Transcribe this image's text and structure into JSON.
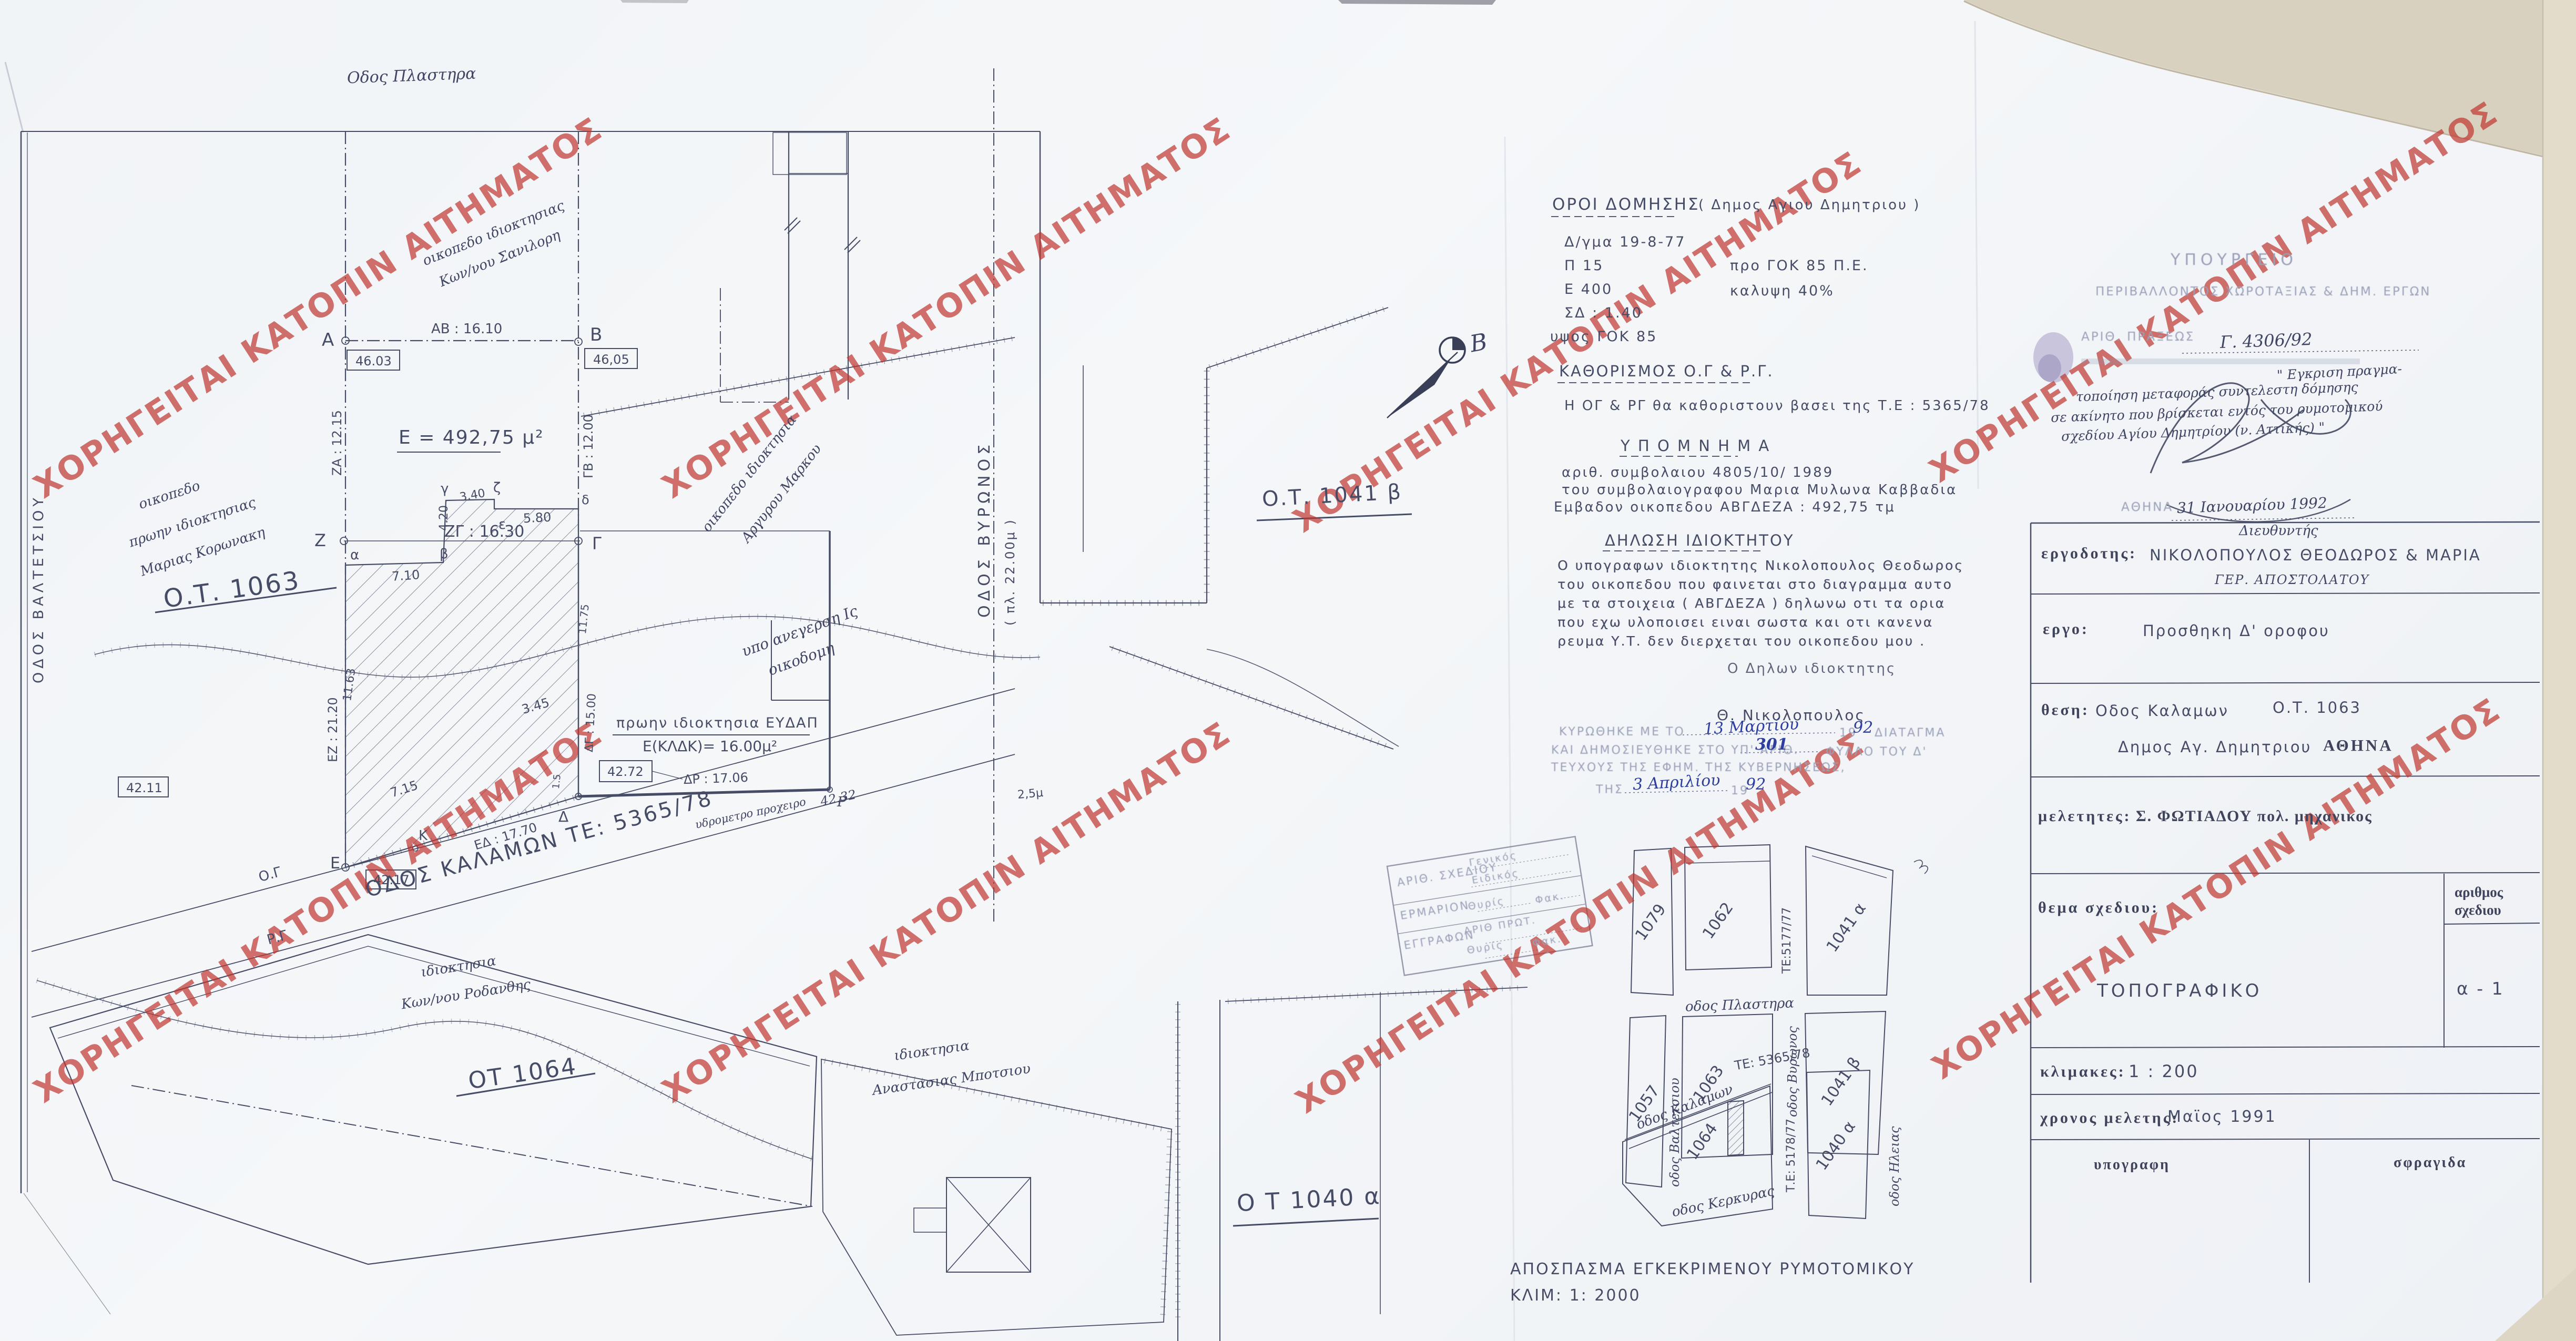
{
  "colors": {
    "ink": "#474c66",
    "watermark_red": "#bf342d",
    "hand_blue": "#2e3e9e",
    "paper": "#f2f4f6",
    "torn_edge": "#d9d1bf"
  },
  "watermark": {
    "text": "ΧΟΡΗΓΕΙΤΑΙ ΚΑΤΟΠΙΝ ΑΙΤΗΜΑΤΟΣ"
  },
  "terms": {
    "title": "ΟΡΟΙ  ΔΟΜΗΣΗΣ",
    "title_suffix": "( Δημος Αγιου Δημητριου )",
    "l1": "Δ/γμα   19-8-77",
    "l2a": "Π   15",
    "l2b": "προ ΓΟΚ 85  Π.Ε.",
    "l3a": "Ε   400",
    "l3b": "καλυψη   40%",
    "l4": "ΣΔ : 1.40",
    "l5": "υψος  ΓΟΚ  85"
  },
  "kathorismos": {
    "title": "ΚΑΘΟΡΙΣΜΟΣ  Ο.Γ  &  Ρ.Γ.",
    "body": "Η   ΟΓ  &  ΡΓ  θα καθοριστουν   βασει της  Τ.Ε : 5365/78"
  },
  "ypomnima": {
    "title": "Υ Π Ο Μ Ν Η Μ Α",
    "l1": "αριθ. συμβολαιου     4805/10/ 1989",
    "l2": "του συμβολαιογραφου  Μαρια  Μυλωνα  Καββαδια",
    "l3": "Εμβαδον οικοπεδου  ΑΒΓΔΕΖΑ   :  492,75 τμ"
  },
  "declaration": {
    "title": "ΔΗΛΩΣΗ  ΙΔΙΟΚΤΗΤΟΥ",
    "p1": "Ο    υπογραφων    ιδιοκτητης    Νικολοπουλος  Θεοδωρος",
    "p2": "του  οικοπεδου  που  φαινεται   στο  διαγραμμα  αυτο",
    "p3": "με  τα  στοιχεια ( ΑΒΓΔΕΖΑ )  δηλωνω  οτι   τα  ορια",
    "p4": "που  εχω  υλοποισει  ειναι  σωστα    και  οτι   κανενα",
    "p5": "ρευμα  Υ.Τ.   δεν  διερχεται   του  οικοπεδου  μου .",
    "signoff": "Ο   Δηλων  ιδιοκτητης",
    "signature": "Θ.  Νικολοπουλος"
  },
  "ratification": {
    "l1_pre": "ΚΥΡΩΘΗΚΕ ΜΕ ΤΟ",
    "l1_hand": "13  Μαρτίου",
    "l1_year_pre": "19",
    "l1_year_hand": "92",
    "l1_post": "ΔΙΑΤΑΓΜΑ",
    "l2_pre": "ΚΑΙ ΔΗΜΟΣΙΕΥΘΗΚΕ ΣΤΟ ΥΠ' ΑΡΙΘ.",
    "l2_hand": "301",
    "l2_post": "ΦΥΛΛΟ ΤΟΥ Δ'",
    "l3": "ΤΕΥΧΟΥΣ ΤΗΣ ΕΦΗΜ. ΤΗΣ ΚΥΒΕΡΝΗΣΕΩΣ,",
    "l4_pre": "ΤΗΣ",
    "l4_hand": "3  Απριλίου",
    "l4_year_pre": "19",
    "l4_year_hand": "92"
  },
  "registry": {
    "r1_label": "ΑΡΙΘ. ΣΧΕΔΙΟΥ",
    "r1_a": "Γενικός",
    "r1_b": "Ειδικός",
    "r2_label": "ΕΡΜΑΡΙΟΝ",
    "r2_a": "Θυρίς",
    "r2_b": "Φακ.",
    "r3_label": "ΕΓΓΡΑΦΩΝ",
    "r3_a": "ΑΡΙΘ ΠΡΩΤ.",
    "r3_b": "Θυρίς",
    "r3_c": "Φακ."
  },
  "approval": {
    "ministry_1": "ΥΠΟΥΡΓΕΙΟ",
    "ministry_2": "ΠΕΡΙΒΑΛΛΟΝΤΟΣ  ΧΩΡΟΤΑΞΙΑΣ  &  ΔΗΜ. ΕΡΓΩΝ",
    "praxis_label": "ΑΡΙΘ. ΠΡΑΞΕΩΣ",
    "praxis_no": "Γ. 4306/92",
    "note_1": "\" Εγκριση πραγμα-",
    "note_2": "τοποίηση μεταφοράς συντελεστη δόμησης",
    "note_3": "σε ακίνητο που βρίσκεται εντός του ρυμοτομικού",
    "note_4": "σχεδίου Αγίου Δημητρίου (ν. Αττικής) \"",
    "city": "ΑΘΗΝΑ",
    "date": "31  Ιανουαρίου 1992",
    "role": "Διευθυντής",
    "signer": "ΓΕΡ. ΑΠΟΣΤΟΛΑΤΟΥ"
  },
  "title_block": {
    "ergodotis_label": "εργοδοτης:",
    "ergodotis": "ΝΙΚΟΛΟΠΟΥΛΟΣ   ΘΕΟΔΩΡΟΣ  &  ΜΑΡΙΑ",
    "ergo_label": "εργο:",
    "ergo": "Προσθηκη     Δ'     οροφου",
    "thesi_label": "θεση:",
    "thesi_street": "Οδος  Καλαμων",
    "thesi_ot": "Ο.Τ.  1063",
    "thesi_dimos": "Δημος   Αγ. Δημητριου",
    "thesi_city": "ΑΘΗΝΑ",
    "meletites_label": "μελετητες:",
    "meletites": "Σ. ΦΩΤΙΑΔΟΥ   πολ. μηχανικος",
    "thema_label": "θεμα  σχεδιου:",
    "thema": "ΤΟΠΟΓΡΑΦΙΚΟ",
    "arithmos_label_1": "αριθμος",
    "arithmos_label_2": "σχεδιου",
    "arithmos": "α    - 1",
    "klimakes_label": "κλιμακες:",
    "klimakes": "1 : 200",
    "xronos_label": "χρονος  μελετης:",
    "xronos": "Μαϊος    1991",
    "ypografi": "υπογραφη",
    "sfragida": "σφραγιδα"
  },
  "plan": {
    "street_plastira": "Οδος  Πλαστηρα",
    "street_valtetsiou": "ΟΔΟΣ  ΒΑΛΤΕΤΣΙΟΥ",
    "street_vyronos": "ΟΔΟΣ    ΒΥΡΩΝΟΣ",
    "street_vyronos_width": "( πλ. 22.00μ )",
    "street_kalamon": "ΟΔΟΣ   ΚΑΛΑΜΩΝ    ΤΕ: 5365/78",
    "og": "Ο.Γ",
    "rg": "Ρ.Γ",
    "ot_1063": "Ο.Τ.  1063",
    "ot_1041b": "Ο.Τ. 1041 β",
    "ot_1064": "ΟΤ 1064",
    "ot_1040a": "Ο Τ  1040 α",
    "area": "Ε = 492,75 μ²",
    "dim_ab": "ΑΒ : 16.10",
    "dim_za": "ΖΑ : 12.15",
    "dim_gb": "ΓΒ : 12.00",
    "dim_zg": "ΖΓ : 16.30",
    "dim_ez": "ΕΖ : 21.20",
    "dim_ed": "ΕΔ : 17.70",
    "dim_dr": "ΔΡ : 17.06",
    "dim_dg": "ΔΓ : 15.00",
    "dim_710": "7.10",
    "dim_420": "4.20",
    "dim_340": "3.40",
    "dim_580": "5.80",
    "dim_1163": "11.63",
    "dim_1175": "11.75",
    "dim_715": "7.15",
    "dim_345": "3.45",
    "dim_15": "1.5",
    "dim_25": "2,5μ",
    "elev_a": "46.03",
    "elev_b": "46,05",
    "elev_e": "42.17",
    "elev_r": "42.72",
    "elev_k": "42.11",
    "elev_hydro": "42.32",
    "pt_a": "Α",
    "pt_b": "Β",
    "pt_g": "Γ",
    "pt_z": "Ζ",
    "pt_e": "Ε",
    "pt_d": "Δ",
    "pt_k": "Κ",
    "pt_r": "Ρ",
    "pt_alpha": "α",
    "pt_beta": "β",
    "pt_gamma": "γ",
    "pt_delta": "δ",
    "pt_eps": "ε",
    "pt_zeta": "ζ",
    "note_koronaki_1": "οικοπεδο",
    "note_koronaki_2": "πρωην ιδιοκτησιας",
    "note_koronaki_3": "Μαριας  Κορωνακη",
    "note_top_1": "οικοπεδο ιδιοκτησιας",
    "note_top_2": "Κων/νου  Σανιλορη",
    "note_argyrou_1": "οικοπεδο ιδιοκτησια",
    "note_argyrou_2": "Αργυρου  Μαρκου",
    "note_anegersi_1": "υπο ανεγερση  Ις",
    "note_anegersi_2": "οικοδομη",
    "note_eydap_1": "πρωην ιδιοκτησια  ΕΥΔΑΠ",
    "note_eydap_2": "Ε(ΚΛΔΚ)= 16.00μ²",
    "note_rodanthis_1": "ιδιοκτησια",
    "note_rodanthis_2": "Κων/νου  Ροδανθης",
    "note_botsiou_1": "ιδιοκτησια",
    "note_botsiou_2": "Αναστασιας  Μποτσιου",
    "note_hydro": "υδρομετρο  προχειρο",
    "north_label": "Β"
  },
  "inset": {
    "caption_1": "ΑΠΟΣΠΑΣΜΑ  ΕΓΚΕΚΡΙΜΕΝΟΥ  ΡΥΜΟΤΟΜΙΚΟΥ",
    "caption_2": "ΚΛΙΜ:   1: 2000",
    "b_1079": "1079",
    "b_1062": "1062",
    "b_1041a": "1041 α",
    "b_1057": "1057",
    "b_1063": "1063",
    "b_1041b": "1041 β",
    "b_1064": "1064",
    "b_1040a": "1040 α",
    "s_plastira": "οδος Πλαστηρα",
    "s_valtetsiou": "οδος Βαλτετσιου",
    "s_vyronos": "οδος Βυρωνος",
    "s_te5177": "ΤΕ:5177/77",
    "s_ilias": "οδος Ηλειας",
    "s_kalamon": "οδος Καλαμων",
    "s_te5365": "ΤΕ: 5365/78",
    "s_kerkyras": "οδος Κερκυρας",
    "s_te5178": "Τ.Ε: 5178/77"
  }
}
